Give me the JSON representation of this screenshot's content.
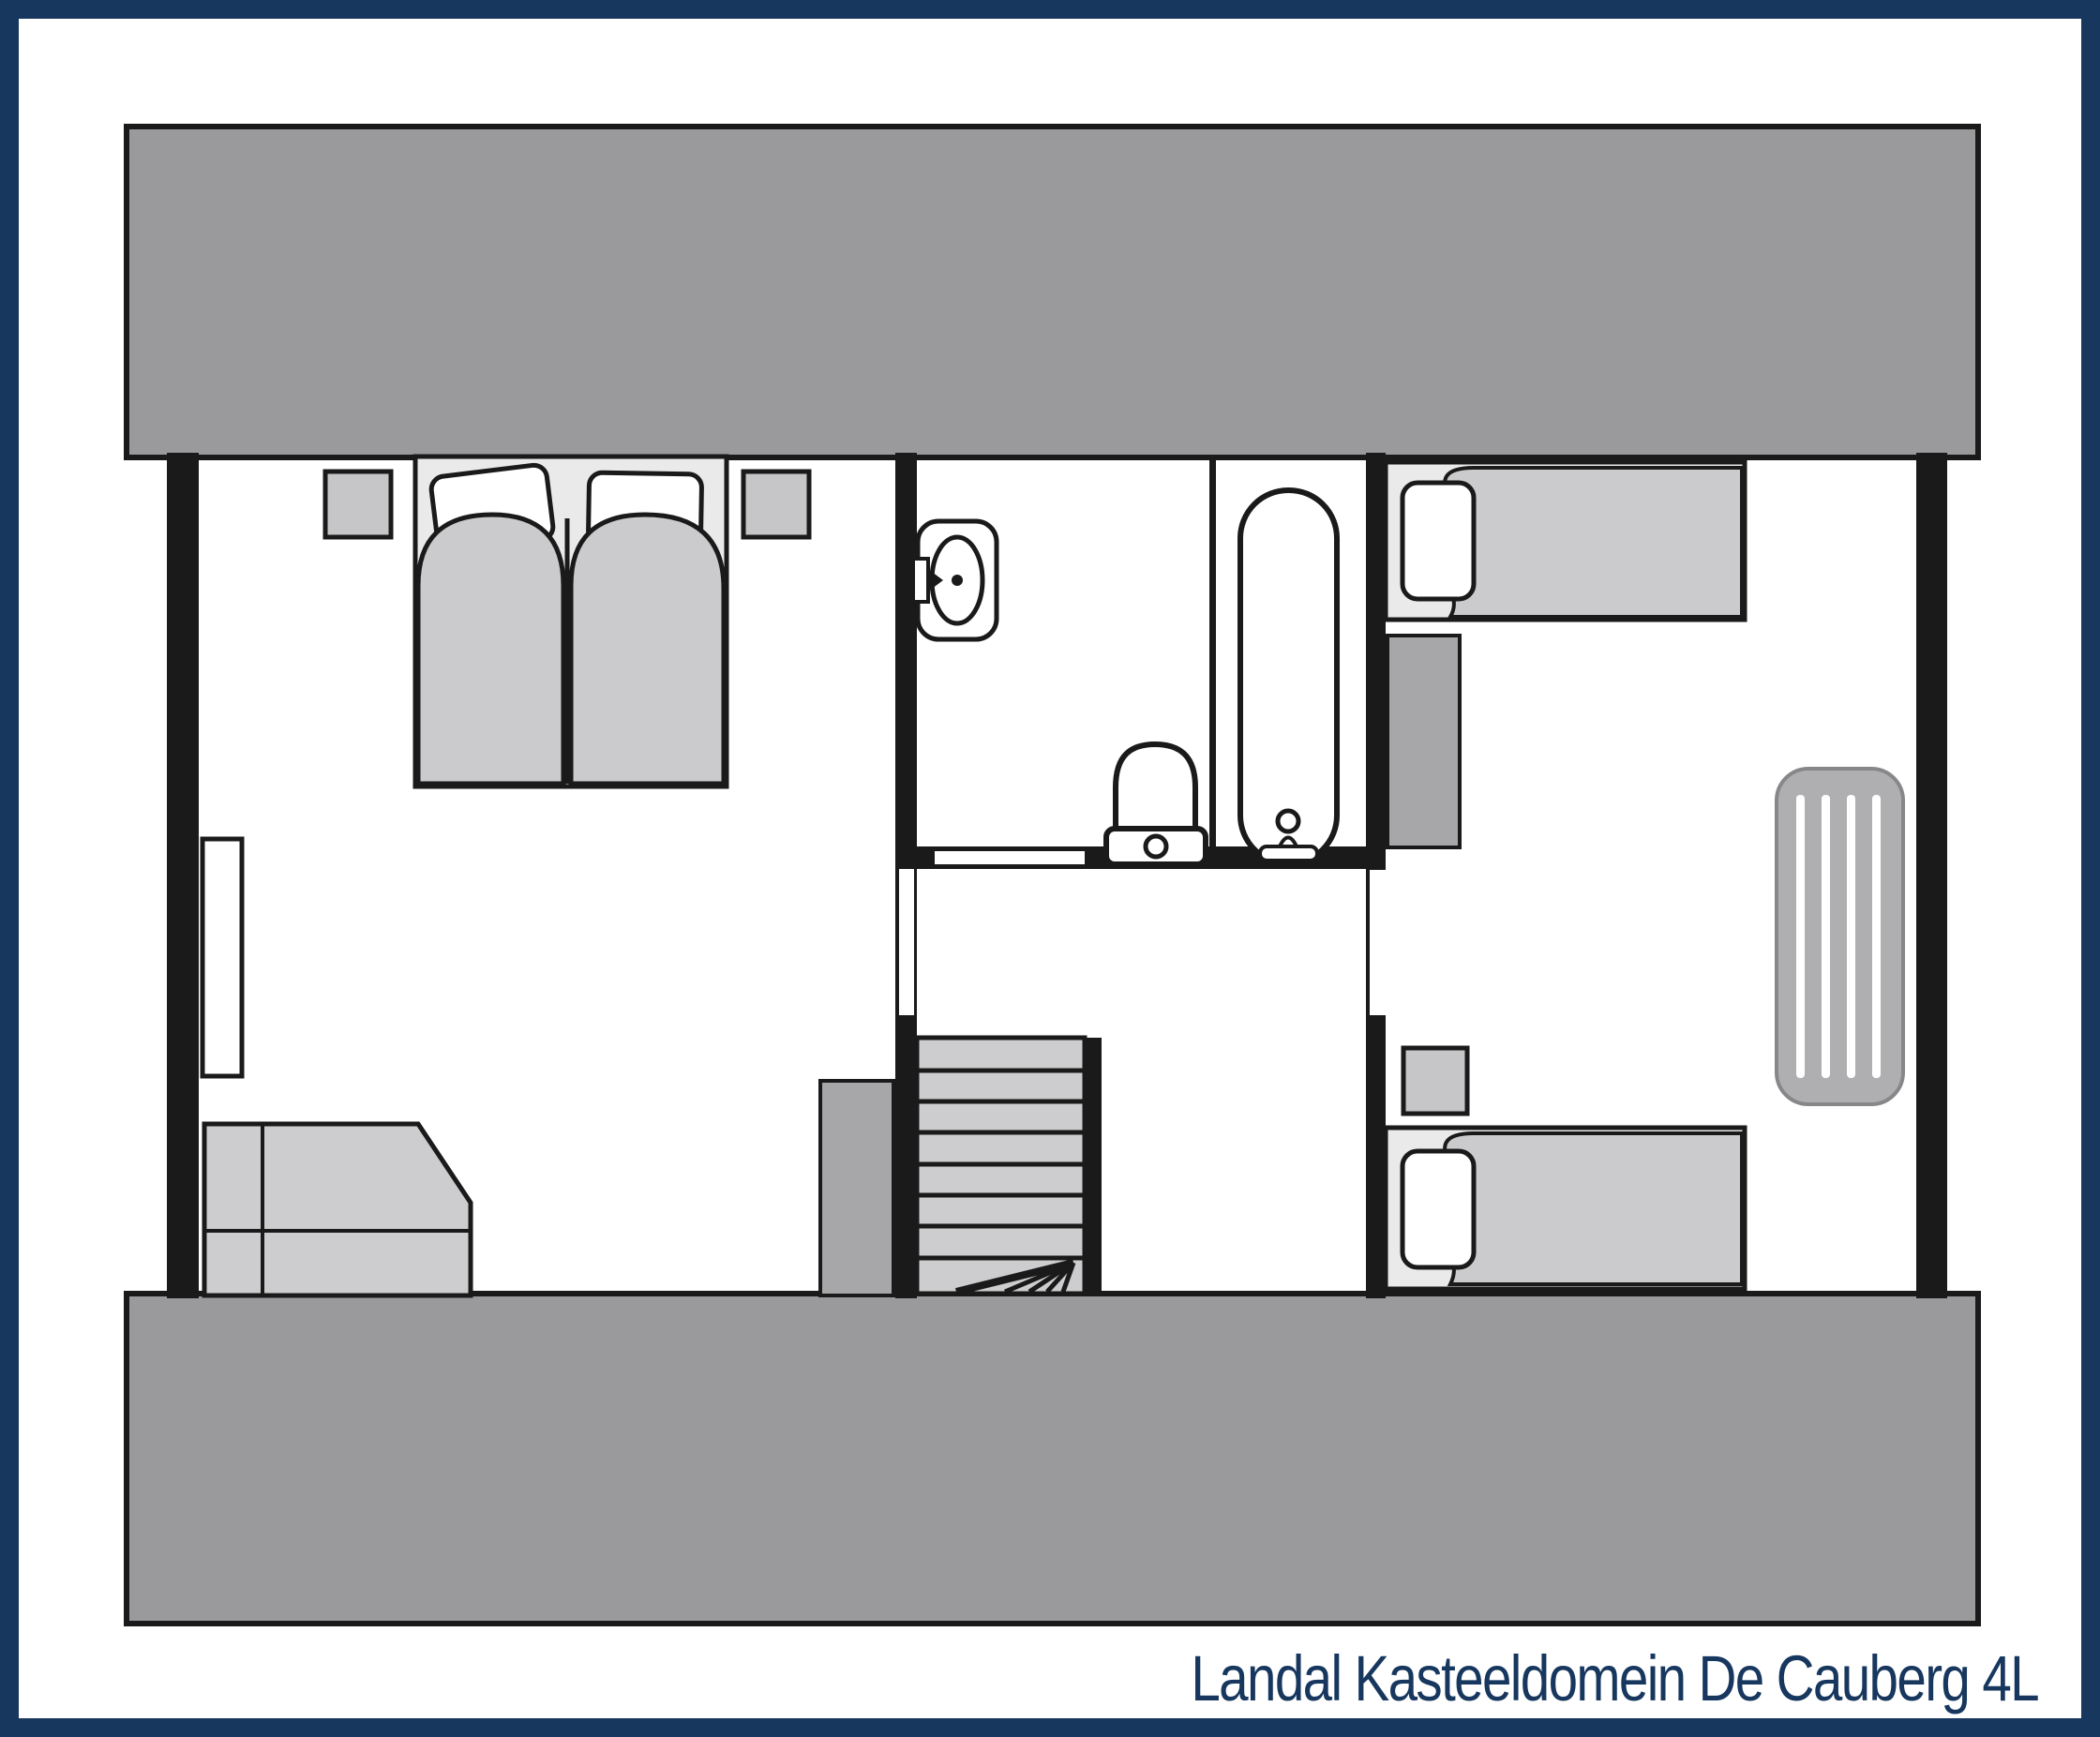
{
  "title": {
    "text": "Landal Kasteeldomein De Cauberg 4L"
  },
  "colors": {
    "border_navy": "#17375E",
    "roof_gray": "#9A9A9C",
    "wall_black": "#1A1A1A",
    "furniture_light_gray": "#CBCBCD",
    "nightstand_gray": "#C6C6C8",
    "closet_dark_gray": "#A7A7A9",
    "bed_base_gray": "#EAEAEB",
    "air_mattress_gray": "#AFAFB1",
    "white": "#FFFFFF"
  },
  "floorplan": {
    "floor": "upper floor (4L cottage)",
    "areas": [
      "left-bedroom",
      "bathroom",
      "landing",
      "staircase",
      "right-bedroom"
    ],
    "fixtures": [
      "double-bed",
      "pillows",
      "duvets",
      "nightstand-left",
      "nightstand-right",
      "dormer-window",
      "wardrobe-chamfered",
      "closet-by-stairs",
      "washbasin",
      "toilet",
      "bathtub",
      "stairs-with-winders",
      "single-bed-top",
      "single-bed-bottom",
      "closet-right-bedroom",
      "nightstand-right-bedroom",
      "air-mattress",
      "roof-slope-top",
      "roof-slope-bottom"
    ]
  }
}
